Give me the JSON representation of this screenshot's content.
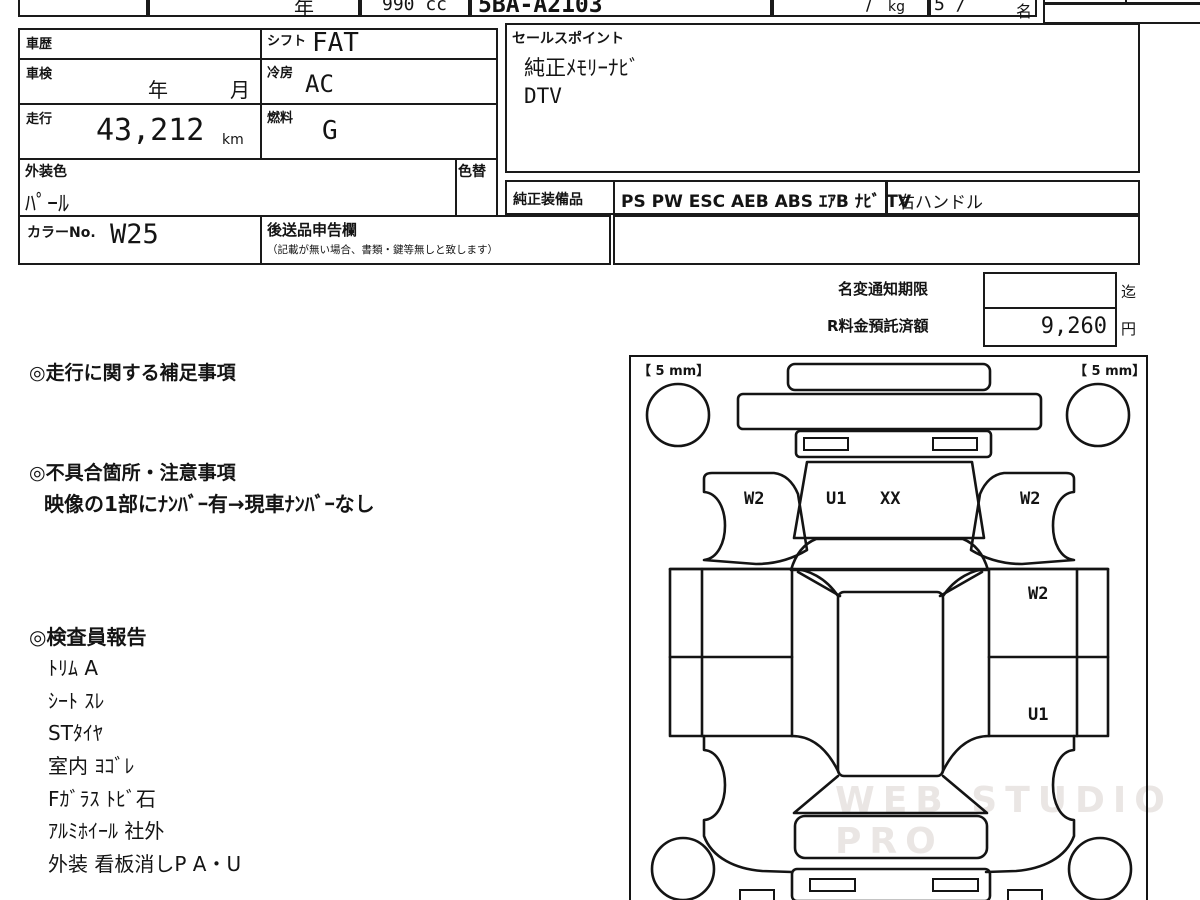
{
  "top_row": {
    "year": "年",
    "displacement": "990 cc",
    "model_code": "5BA-A2103",
    "weight_slash": "/",
    "weight_unit": "kg",
    "capacity": "5 /",
    "capacity_unit": "名"
  },
  "table": {
    "history_label": "車歴",
    "shift_label": "シフト",
    "shift_value": "FAT",
    "inspection_label": "車検",
    "inspection_year": "年",
    "inspection_month": "月",
    "ac_label": "冷房",
    "ac_value": "AC",
    "mileage_label": "走行",
    "mileage_value": "43,212",
    "mileage_unit": "km",
    "fuel_label": "燃料",
    "fuel_value": "G",
    "color_label": "外装色",
    "color_value": "ﾊﾟｰﾙ",
    "repaint_label": "色替",
    "color_no_label": "カラーNo.",
    "color_no_value": "W25",
    "okuri_label": "後送品申告欄",
    "okuri_note": "（記載が無い場合、書類・鍵等無しと致します）"
  },
  "sales_point": {
    "label": "セールスポイント",
    "line1": "純正ﾒﾓﾘｰﾅﾋﾞ",
    "line2": "DTV"
  },
  "equipment": {
    "label": "純正装備品",
    "value": "PS PW ESC AEB ABS ｴｱB ﾅﾋﾞ TV",
    "handle": "右ハンドル"
  },
  "fees": {
    "rename_label": "名変通知期限",
    "rename_value": "",
    "rename_suffix": "迄",
    "deposit_label": "R料金預託済額",
    "deposit_value": "9,260",
    "deposit_suffix": "円"
  },
  "sections": {
    "mileage_note_title": "◎走行に関する補足事項",
    "defect_title": "◎不具合箇所・注意事項",
    "defect_note": "映像の1部にﾅﾝﾊﾞｰ有→現車ﾅﾝﾊﾞｰなし",
    "inspector_title": "◎検査員報告"
  },
  "inspector_items": [
    "ﾄﾘﾑ A",
    "ｼｰﾄ ｽﾚ",
    "STﾀｲﾔ",
    "室内 ﾖｺﾞﾚ",
    "Fｶﾞﾗｽ ﾄﾋﾞ石",
    "ｱﾙﾐﾎｲｰﾙ 社外",
    "外装 看板消しP A・U"
  ],
  "diagram": {
    "tread_left": "【 5 mm】",
    "tread_right": "【 5 mm】",
    "markers": [
      {
        "text": "W2"
      },
      {
        "text": "U1"
      },
      {
        "text": "XX"
      },
      {
        "text": "W2"
      },
      {
        "text": "W2"
      },
      {
        "text": "U1"
      }
    ],
    "watermark": "WEB STUDIO PRO"
  }
}
